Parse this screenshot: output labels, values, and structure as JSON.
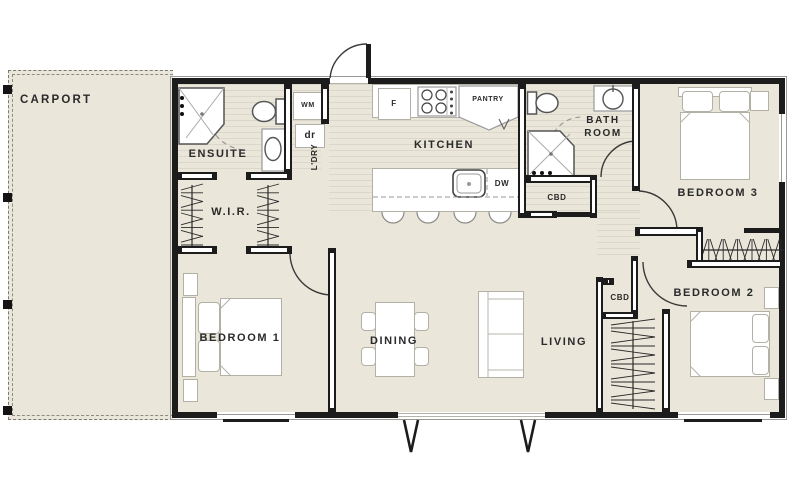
{
  "rooms": {
    "carport": "CARPORT",
    "ensuite": "ENSUITE",
    "wir": "W.I.R.",
    "laundry": "L'DRY",
    "kitchen": "KITCHEN",
    "bathroom": "BATH\nROOM",
    "bedroom1": "BEDROOM 1",
    "bedroom2": "BEDROOM 2",
    "bedroom3": "BEDROOM 3",
    "dining": "DINING",
    "living": "LIVING"
  },
  "fixtures": {
    "fridge": "F",
    "washing_machine": "WM",
    "dryer": "dr",
    "pantry": "PANTRY",
    "dishwasher": "DW",
    "hall_cupboard": "CBD",
    "bedroom2_cupboard": "CBD"
  },
  "colors": {
    "floor": "#eae6da",
    "wall": "#1c1c1c",
    "carport_outline": "#7a7a74",
    "furniture_outline": "#b3b0a6",
    "fixture_outline": "#555555",
    "label_text": "#2a2a2a"
  }
}
